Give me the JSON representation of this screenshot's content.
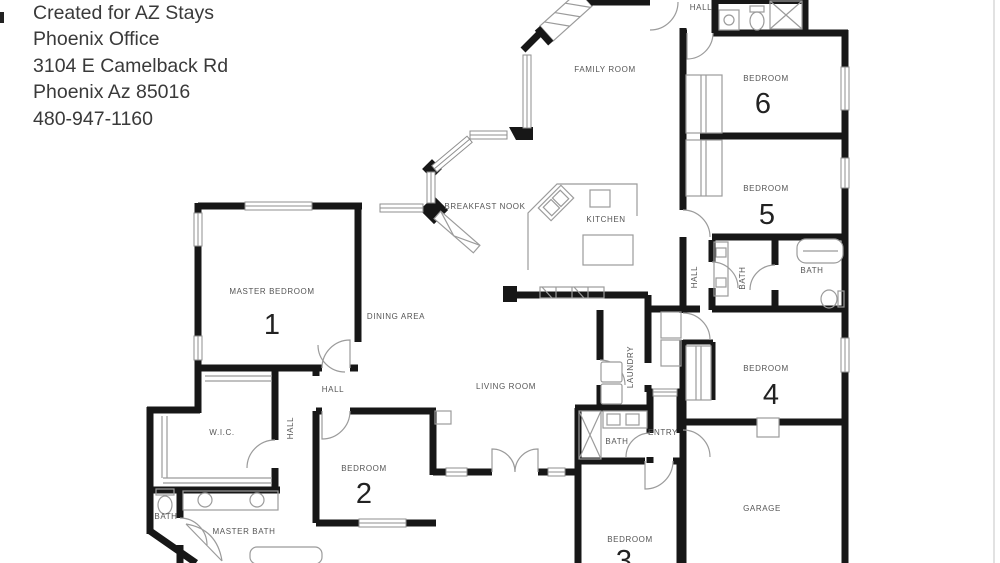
{
  "header": {
    "lines": [
      "Created for AZ Stays",
      "Phoenix Office",
      "3104 E Camelback Rd",
      "Phoenix Az 85016",
      "480-947-1160"
    ]
  },
  "floorplan": {
    "type": "single-story residential floor plan, 6 bedrooms",
    "colors": {
      "wall": "#171717",
      "thin_line": "#9b9b9b",
      "label": "#555555"
    },
    "rooms": [
      {
        "id": "family-room",
        "label": "FAMILY ROOM"
      },
      {
        "id": "hall-top",
        "label": "HALL"
      },
      {
        "id": "bedroom-6",
        "label": "BEDROOM",
        "number": "6"
      },
      {
        "id": "bedroom-5",
        "label": "BEDROOM",
        "number": "5"
      },
      {
        "id": "breakfast-nook",
        "label": "BREAKFAST NOOK"
      },
      {
        "id": "kitchen",
        "label": "KITCHEN"
      },
      {
        "id": "master-bedroom",
        "label": "MASTER BEDROOM",
        "number": "1"
      },
      {
        "id": "dining-area",
        "label": "DINING AREA"
      },
      {
        "id": "hall-corridor",
        "label": "HALL"
      },
      {
        "id": "hall-mid",
        "label": "HALL"
      },
      {
        "id": "wic",
        "label": "W.I.C."
      },
      {
        "id": "living-room",
        "label": "LIVING ROOM"
      },
      {
        "id": "laundry",
        "label": "LAUNDRY"
      },
      {
        "id": "bath-left",
        "label": "BATH"
      },
      {
        "id": "master-bath",
        "label": "MASTER BATH"
      },
      {
        "id": "bedroom-2",
        "label": "BEDROOM",
        "number": "2"
      },
      {
        "id": "bath-hall",
        "label": "BATH"
      },
      {
        "id": "entry",
        "label": "ENTRY"
      },
      {
        "id": "bedroom-3",
        "label": "BEDROOM",
        "number": "3"
      },
      {
        "id": "bedroom-4",
        "label": "BEDROOM",
        "number": "4"
      },
      {
        "id": "bath-right-a",
        "label": "BATH"
      },
      {
        "id": "bath-right-b",
        "label": "BATH"
      },
      {
        "id": "hall-right",
        "label": "HALL"
      },
      {
        "id": "garage",
        "label": "GARAGE"
      }
    ]
  }
}
